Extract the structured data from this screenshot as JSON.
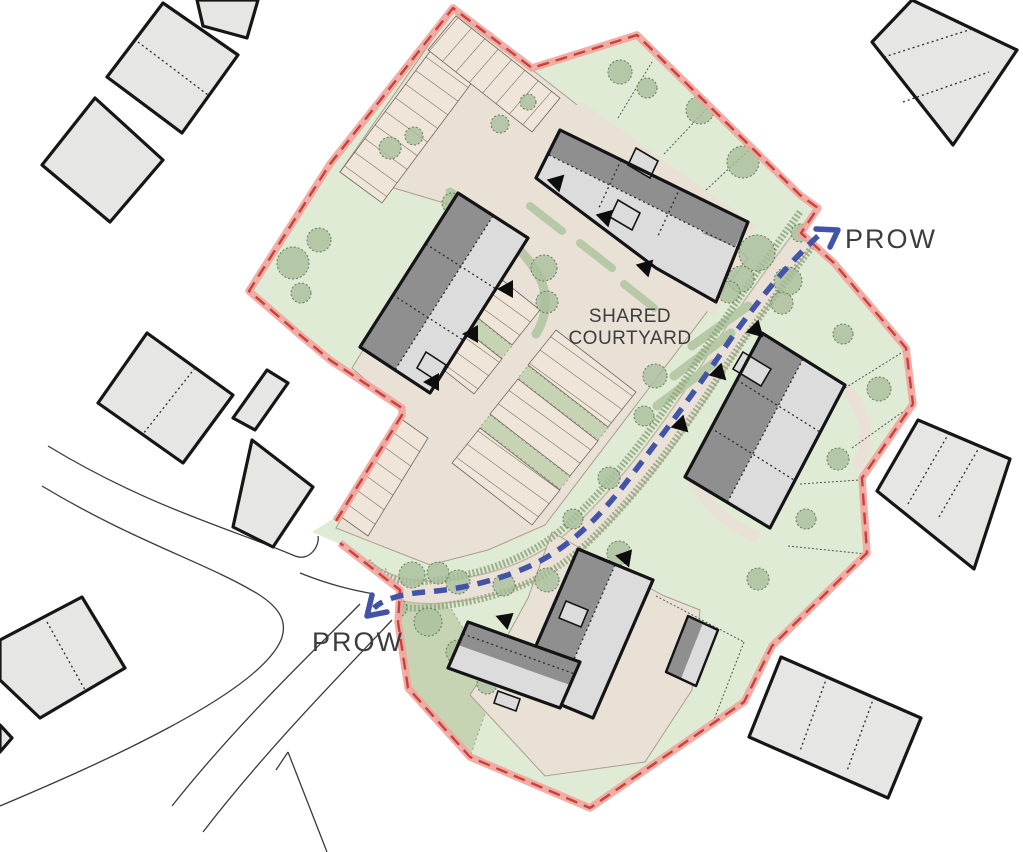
{
  "labels": {
    "prow_upper": "PROW",
    "prow_lower": "PROW",
    "shared_courtyard_line1": "SHARED",
    "shared_courtyard_line2": "COURTYARD"
  },
  "colors": {
    "page_bg": "#ffffff",
    "boundary_band": "#f2a49d",
    "boundary_dash": "#c8413a",
    "prow_route": "#4254a8",
    "landscape_green": "#dfebd5",
    "landscape_green_dark": "#c7d4b4",
    "hedge_green": "#b7c9a6",
    "tree_green": "#a9bf9c",
    "paving": "#eae1d6",
    "parking": "#efe5d8",
    "roof_dark": "#8f8f8f",
    "roof_light": "#dcdcdc",
    "building_outline": "#141414",
    "offsite_building": "#e6e6e4",
    "road_line": "#3a3a3a",
    "label_text": "#3d3d3d"
  }
}
